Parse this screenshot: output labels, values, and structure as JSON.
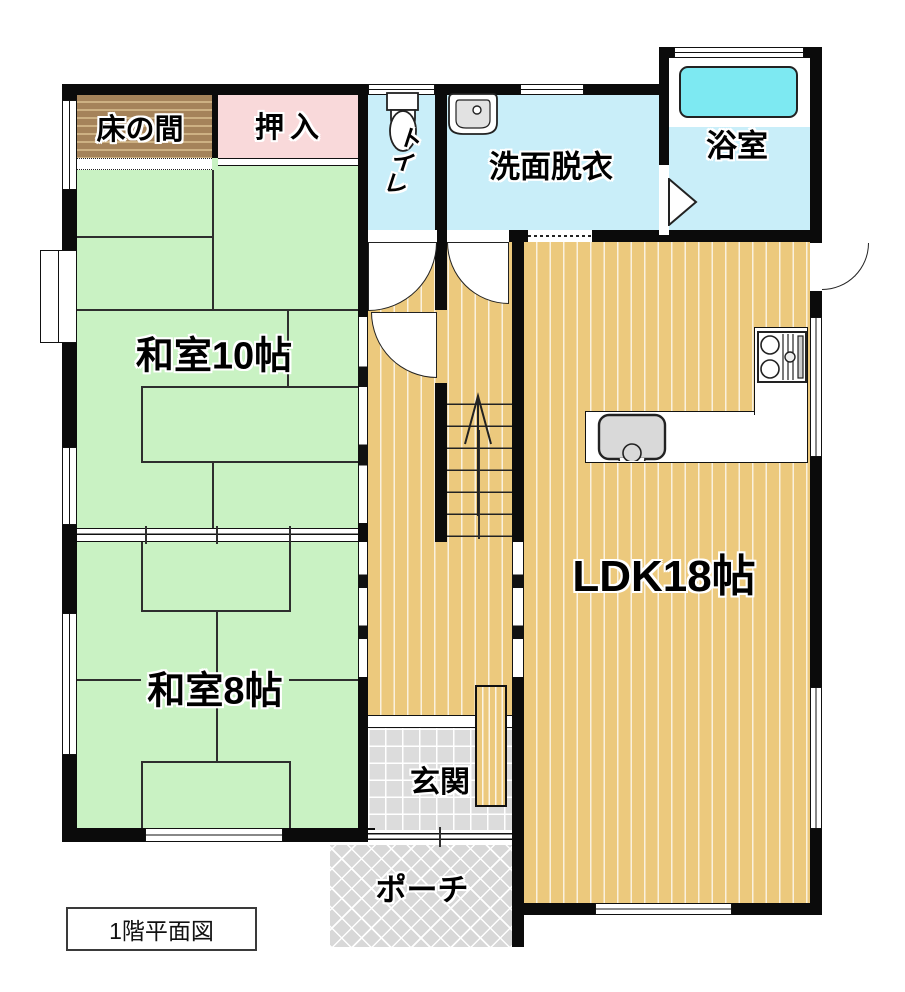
{
  "rooms": {
    "tokonoma": {
      "label": "床の間"
    },
    "oshiire": {
      "label": "押入"
    },
    "toilet": {
      "label": "トイレ"
    },
    "washroom": {
      "label": "洗面脱衣"
    },
    "bathroom": {
      "label": "浴室"
    },
    "washitsu10": {
      "label": "和室10帖"
    },
    "washitsu8": {
      "label": "和室8帖"
    },
    "ldk": {
      "label": "LDK18帖"
    },
    "genkan": {
      "label": "玄関"
    },
    "porch": {
      "label": "ポーチ"
    }
  },
  "caption": {
    "floor_plan_label": "1階平面図"
  },
  "icons": {
    "toilet": "toilet-icon",
    "washroom_sink": "sink-icon",
    "bathtub": "bathtub-icon",
    "stove": "stove-icon",
    "kitchen_sink": "kitchen-sink-icon",
    "stairs_arrow": "stairs-up-arrow-icon"
  },
  "colors": {
    "wall": "#0b0b0b",
    "tatami_green": "#c9f2c3",
    "wood_floor": "#ecc97d",
    "wet_room_cyan": "#c9eef9",
    "bathtub_cyan": "#7de9f2",
    "closet_pink": "#f9d9da",
    "tokonoma_brown": "#a5835a",
    "entrance_tile": "#dcdcdc",
    "porch_grey": "#d8d8d8"
  }
}
